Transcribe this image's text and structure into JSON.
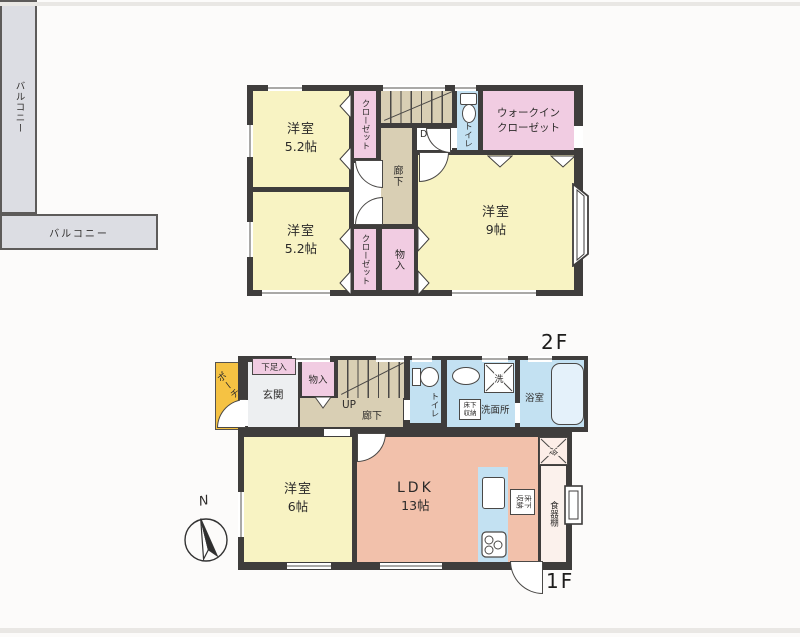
{
  "colors": {
    "wall": "#3f3d3c",
    "room_yellow": "#f8f3c3",
    "closet_pink": "#f1cce2",
    "wet_area_blue": "#c3e1f2",
    "ldk_salmon": "#f2c1ab",
    "corridor_beige": "#d9cfb4",
    "balcony_gray": "#dcdde3",
    "porch_yellow": "#f5c243"
  },
  "floor2": {
    "floor_label": "2F",
    "balcony_left_label": "バルコニー",
    "balcony_bottom_label": "バルコニー",
    "bedroom1": {
      "name": "洋室",
      "size": "5.2帖"
    },
    "bedroom2": {
      "name": "洋室",
      "size": "5.2帖"
    },
    "bedroom3": {
      "name": "洋室",
      "size": "9帖"
    },
    "walkin_closet": {
      "line1": "ウォークイン",
      "line2": "クローゼット"
    },
    "closet_top_label": "クローゼット",
    "closet_bottom_label": "クローゼット",
    "storage_label": "物入",
    "hallway_label": "廊下",
    "stairs_label": "DN",
    "toilet_label": "トイレ"
  },
  "floor1": {
    "floor_label": "1F",
    "compass_label": "N",
    "porch_label": "ポーチ",
    "shoe_cabinet_label": "下足入",
    "entrance_label": "玄関",
    "storage_label": "物入",
    "stairs_label": "UP",
    "hallway_label": "廊下",
    "toilet_label": "トイレ",
    "washroom_label": "洗面所",
    "washer_label": "洗",
    "underfloor_storage_washroom_label": "床下収納",
    "bathroom_label": "浴室",
    "bedroom": {
      "name": "洋室",
      "size": "6帖"
    },
    "ldk": {
      "name": "LDK",
      "size": "13帖"
    },
    "underfloor_storage_kitchen_label": "床下収納",
    "refrigerator_label": "冷",
    "cupboard_label": "食器棚"
  }
}
